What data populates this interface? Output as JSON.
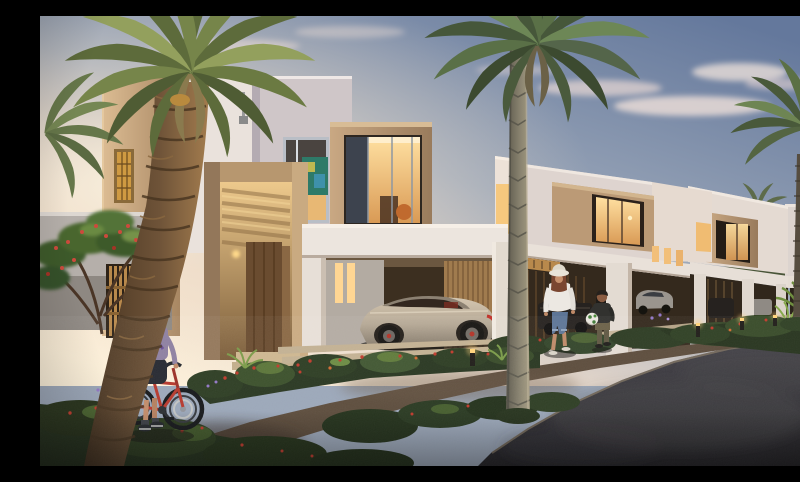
{
  "meta": {
    "domain": "natural-image",
    "description": "Photorealistic dusk rendering of a modern townhouse community: white and sand-stone two-storey homes with glowing windows, carports with parked cars, landscaped beds with red and purple flowers, tall date palms, a woman in a sun hat walking with a small child holding a football, and a boy in a purple cap pushing a red bicycle along a gravel garden path beside an asphalt road.",
    "time_of_day": "dusk",
    "setting": "residential townhouse development"
  },
  "palette": {
    "sky_top": "#64789c",
    "sky_mid": "#9aa6b8",
    "sky_horizon": "#e8d8c9",
    "sunset_glow": "#fdf1da",
    "cloud": "#e9d9d4",
    "wall_white": "#eae2dc",
    "wall_shadow": "#cfc6c8",
    "stone_tan": "#bb9a76",
    "stone_tan_dark": "#96795a",
    "wood_slat": "#b8894c",
    "window_glow": "#f6c87e",
    "window_glow_bright": "#ffe0a1",
    "foliage_dark": "#22301b",
    "foliage_mid": "#3d5329",
    "foliage_light": "#67853c",
    "palm_green": "#5c7046",
    "palm_trunk": "#6e5338",
    "flower_red": "#c0392b",
    "flower_purple": "#9277c6",
    "gravel": "#5b4b3b",
    "paver": "#c2b092",
    "asphalt": "#2c2b2f",
    "car_champagne": "#b4a794",
    "car_dark": "#26221f",
    "car_silver": "#9a958e",
    "bike_red": "#b5372c",
    "cap_purple": "#7b5fb0",
    "denim_blue": "#5d7596",
    "shirt_white": "#ece8e2"
  },
  "scene": {
    "buildings": [
      {
        "id": "townhouse-1",
        "label": "two-storey townhouse with stone entrance portal, wooden pergola, box bay window and carport"
      },
      {
        "id": "townhouse-2",
        "label": "townhouse with tan box bay window, lit interiors and carport"
      },
      {
        "id": "townhouse-3",
        "label": "townhouse with box window and carport"
      },
      {
        "id": "townhouse-4",
        "label": "townhouse at the end of the row"
      }
    ],
    "vehicles": [
      "champagne sports coupe",
      "dark pickup truck",
      "silver sedan",
      "dark hatchback",
      "silver car",
      "light van"
    ],
    "people": [
      {
        "id": "woman-with-sunhat",
        "label": "woman in white top, sun hat and rolled blue jeans walking"
      },
      {
        "id": "child-with-football",
        "label": "small child in dark jacket holding a white football"
      },
      {
        "id": "boy-with-bicycle",
        "label": "boy in a purple cap pushing a red bicycle"
      }
    ],
    "vegetation": [
      "date palm foreground left",
      "tall palm centre",
      "palm right",
      "distant palms",
      "frangipani with red flowers",
      "flowering shrubs",
      "cycad"
    ],
    "ground": [
      "gravel garden path",
      "stone paver driveways",
      "asphalt road",
      "landscaped flower beds"
    ],
    "details": [
      "wooden slat gate",
      "glowing bollard lights",
      "lit amber windows",
      "dusk clouds"
    ]
  }
}
